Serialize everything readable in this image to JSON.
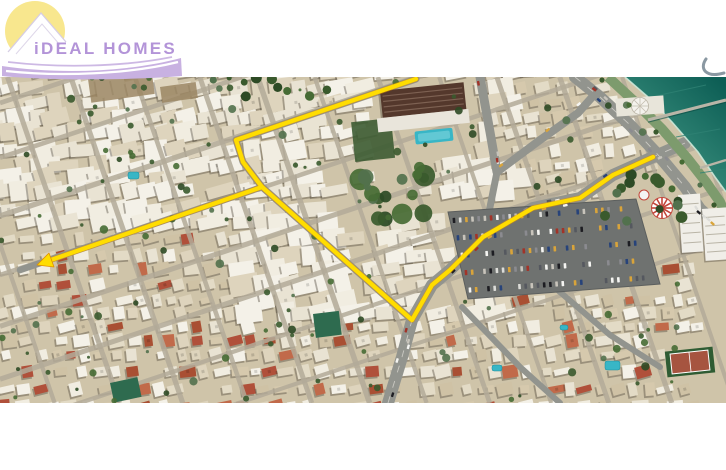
{
  "logo": {
    "text": "iDEAL HOMES",
    "sun_color": "#f8e78e",
    "text_color": "#b394d8",
    "swoosh_color": "#c8b1e1",
    "house_color": "#ffffff",
    "house_outline": "#d6cde4"
  },
  "watermark": {
    "glyph_color": "#8a98a2"
  },
  "map": {
    "photo_top": 77,
    "photo_height": 326,
    "colors": {
      "land": "#cfc4a9",
      "street": "#b3ab99",
      "road": "#92948e",
      "road_line": "#d8d6cf",
      "sea_deep": "#0d5e55",
      "sea_shore": "#4aa18c",
      "surf": "#cde8d8",
      "promenade": "#7d9b6d",
      "pier": "#b9b5a7",
      "route": "#ffdd00",
      "route_fringe": "#e09000",
      "parking": "#6f7270",
      "parking_edge": "#5c5f5e",
      "pool": "#38b6c6",
      "shadow": "#4a4438",
      "construction_green": "#2e6b4f",
      "dirt": "#9b8663",
      "hotel_roof": "#54382c",
      "hotel_stripe": "#7d6152",
      "hotel_podium": "#e9e5db",
      "tennis_outer": "#2f5c33",
      "tennis_inner": "#a65440",
      "carousel_red": "#c2453a",
      "tree_palette": [
        "#3a5a2d",
        "#2d4a25",
        "#466b34",
        "#52714d"
      ],
      "building_palette": [
        "#e9e3d3",
        "#ded4bd",
        "#f1ede1",
        "#d6c9ad",
        "#e3dbc6",
        "#cfc2a5",
        "#f4f1e8"
      ],
      "roof_red_palette": [
        "#b0503a",
        "#a94f33",
        "#c16a4a"
      ],
      "car_palette": [
        "#f5f5f2",
        "#dcdcd8",
        "#1d1d22",
        "#8b8b90",
        "#a23328",
        "#27437a",
        "#c8c4bb",
        "#55585f",
        "#d9a43a"
      ]
    },
    "route": {
      "main_points": "416,2 236,63 243,85 262,110 341,180 412,243 432,208 450,193 483,160 533,131 580,121 613,98 653,80",
      "branch_points": "262,110 48,184",
      "arrow_points": "37,188 49,176 54,190"
    },
    "sea_points": "625,0 648,20 672,45 698,75 715,100 726,115 726,0",
    "parking_points": "448,135 636,122 660,207 468,222",
    "parking_rows": 5,
    "landmarks": {
      "hotel": {
        "x": 380,
        "y": 14,
        "rotation": -6,
        "width": 84,
        "height": 27
      },
      "hotel_pool": {
        "x": 30,
        "y": 44,
        "width": 38,
        "height": 13
      },
      "pavilion": {
        "x": 640,
        "y": 29,
        "radius": 8.5
      },
      "pier": {
        "x1": 648,
        "y1": 43,
        "x2": 726,
        "y2": 23
      },
      "jetty": {
        "x1": 700,
        "y1": 91,
        "x2": 726,
        "y2": 83
      },
      "carousel": {
        "x": 662,
        "y": 131,
        "radius": 10.5
      },
      "small_ride": {
        "x": 644,
        "y": 118,
        "radius": 5
      },
      "tennis_court": {
        "x": 666,
        "y": 272,
        "width": 48,
        "height": 26,
        "rotation": -6
      },
      "towers": [
        [
          678,
          118,
          22,
          58
        ],
        [
          702,
          132,
          24,
          52
        ]
      ],
      "construction_buildings": [
        [
          313,
          237,
          26,
          24,
          -7
        ],
        [
          110,
          306,
          28,
          20,
          -12
        ]
      ],
      "pools": [
        [
          128,
          95,
          11,
          7
        ],
        [
          492,
          288,
          10,
          6
        ],
        [
          605,
          284,
          15,
          9
        ],
        [
          560,
          248,
          8,
          5
        ]
      ],
      "dirt_patches": [
        [
          88,
          2,
          64,
          24,
          -8
        ],
        [
          160,
          10,
          36,
          16,
          -8
        ]
      ]
    }
  }
}
